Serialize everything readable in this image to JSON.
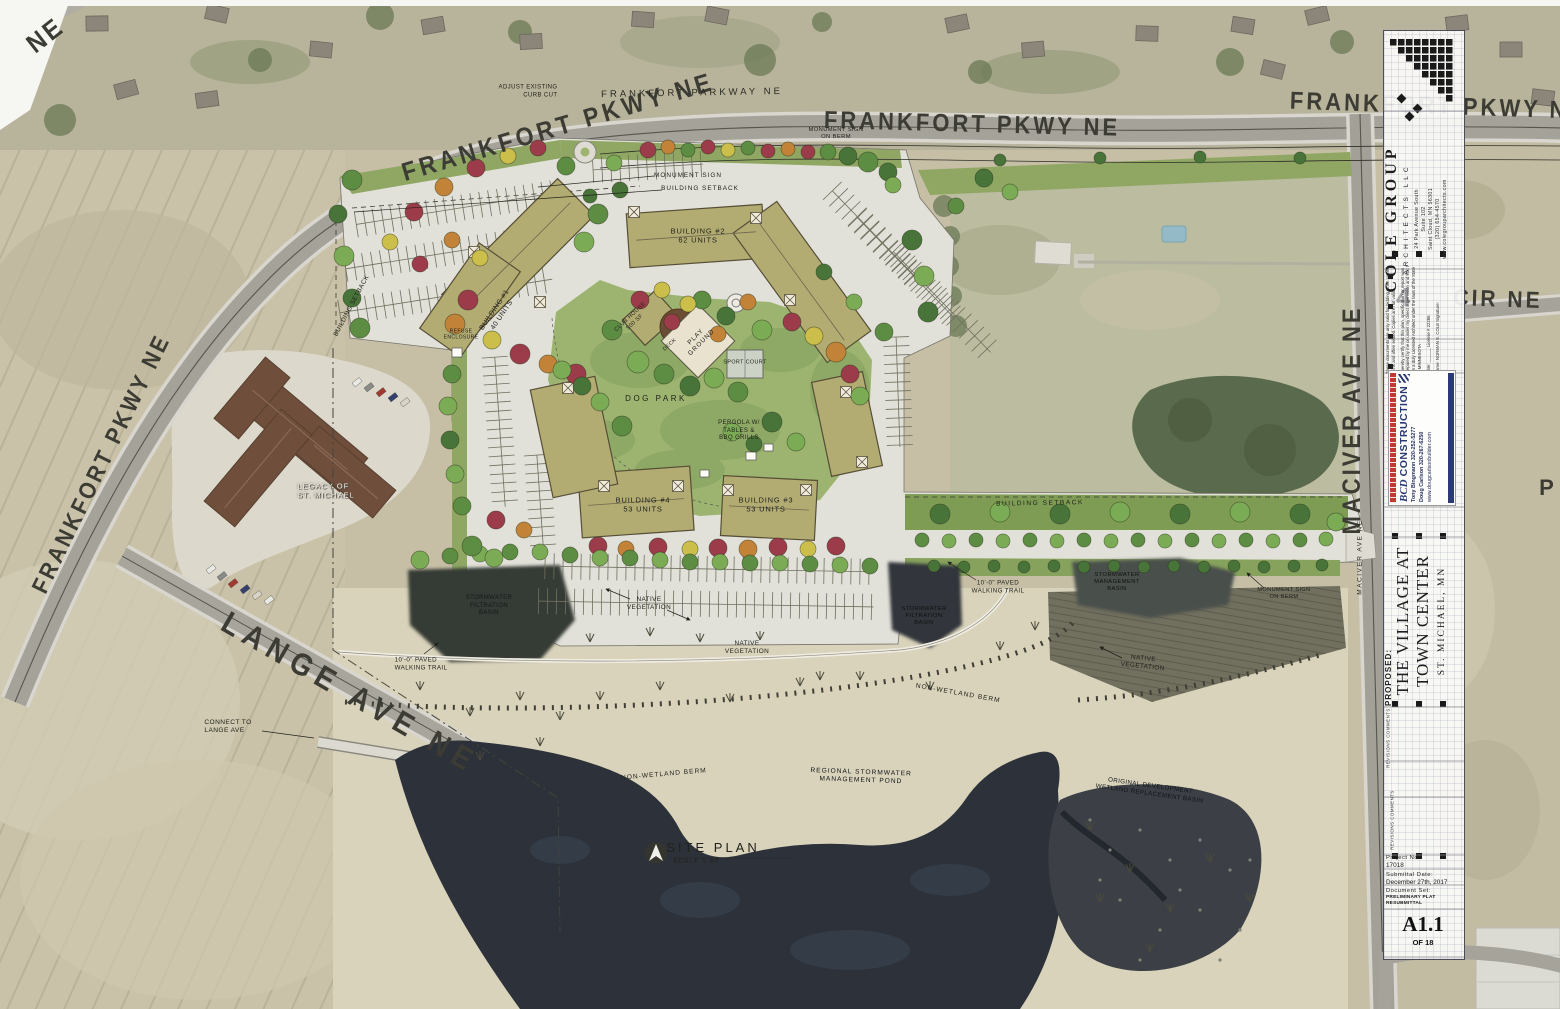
{
  "roads": {
    "ne_corner": "NE",
    "frankfort_nw": "FRANKFORT PKWY NE",
    "frankfort_mid": "FRANKFORT PKWY NE",
    "frankfort_right": "FRANKFORT PKWY NE",
    "frankfort_left": "FRANKFORT PKWY NE",
    "frankfort_drawn": "FRANKFORT PARKWAY NE",
    "cir": "CIR NE",
    "maciver": "MACIVER AVE NE",
    "maciver_drawn": "MACIVER AVE NE",
    "lange": "LANGE AVE NE",
    "partial_right": "P"
  },
  "ann": {
    "adjust_curb": "ADJUST EXISTING\nCURB CUT",
    "monument_ne": "MONUMENT SIGN\nON BERM",
    "monument_nw": "MONUMENT SIGN",
    "setback_n": "BUILDING SETBACK",
    "setback_w": "BUILDING SETBACK",
    "setback_e": "BUILDING SETBACK",
    "b1": "BUILDING #1\n40 UNITS",
    "b2": "BUILDING #2\n62 UNITS",
    "b3": "BUILDING #3\n53 UNITS",
    "b4": "BUILDING #4\n53 UNITS",
    "club": "CLUB HOUSE\n500 SF",
    "deck": "DECK",
    "play": "PLAY\nGROUND",
    "sport": "SPORT COURT",
    "dog": "DOG PARK",
    "pergola": "PERGOLA W/\nTABLES &\nBBQ GRILLS",
    "refuse": "REFUSE\nENCLOSURE",
    "trail_e": "10'-0\" PAVED\nWALKING TRAIL",
    "trail_w": "10'-0\" PAVED\nWALKING TRAIL",
    "basin_w": "STORMWATER\nFILTRATION\nBASIN",
    "basin_c": "STORMWATER\nFILTRATION\nBASIN",
    "basin_e": "STORMWATER\nMANAGEMENT\nBASIN",
    "monument_e": "MONUMENT SIGN\nON BERM",
    "native_1": "NATIVE\nVEGETATION",
    "native_2": "NATIVE\nVEGETATION",
    "native_3": "NATIVE\nVEGETATION",
    "berm_1": "NON-WETLAND BERM",
    "ber m_2": "NON-WETLAND BERM",
    "berm_2": "NON-WETLAND BERM",
    "pond": "REGIONAL STORMWATER\nMANAGEMENT POND",
    "wetland": "ORIGINAL DEVELOPMENT\nWETLAND REPLACEMENT BASIN",
    "connect": "CONNECT TO\nLANGE AVE",
    "legacy": "LEGACY OF\nST. MICHAEL",
    "site_plan": "SITE PLAN",
    "scale": "SCALE 1:60"
  },
  "titleblock": {
    "firm": "COLE GROUP",
    "firm_sub": "ARCHITECTS LLC",
    "address": "24 Park Avenue South\nSuite 102\nSaint Cloud, MN 56301\n(320) 654-4570\nwww.colegrouparchitects.com",
    "note": "These documents are only valid for bidding when signed in ink and often sealed. Copies are not valid.",
    "cert": "I hereby certify that this plan, specification or report was prepared by me or under my direct supervision and that I am a duly Licensed Architect under the laws of the State of MINNESOTA",
    "cert_date": "Date:",
    "cert_license": "License # 22286",
    "cert_name": "Name:  NORMAN E. COLE     Signature:",
    "watermark": "4",
    "construction": {
      "name": "CONSTRUCTION",
      "monogram": "BCD",
      "contact_1": "Tony Bingmann   320-252-5277",
      "contact_2": "Doug Carlson   320-267-6250",
      "website": "www.dougcarlsonbuilder.com"
    },
    "proposed": "PROPOSED:",
    "project_1": "THE VILLAGE AT",
    "project_2": "TOWN CENTER",
    "city": "ST. MICHAEL, MN",
    "revisions": "REVISIONS COMMENTS",
    "project_no_label": "Project   No.:",
    "project_no": "17018",
    "date_label": "Submittal   Date:",
    "date": "December 27th, 2017",
    "set_label": "Document   Set:",
    "set": "PRELIMINARY PLAT RESUBMITTAL",
    "sheet": "A1.1",
    "sheet_of": "OF 18"
  },
  "colors": {
    "pond": "#2c313a",
    "building": "#b2ac72",
    "paving": "#e2e1d9",
    "green": "#9cb470",
    "construction_red": "#c03a32",
    "construction_navy": "#2b3a72"
  }
}
